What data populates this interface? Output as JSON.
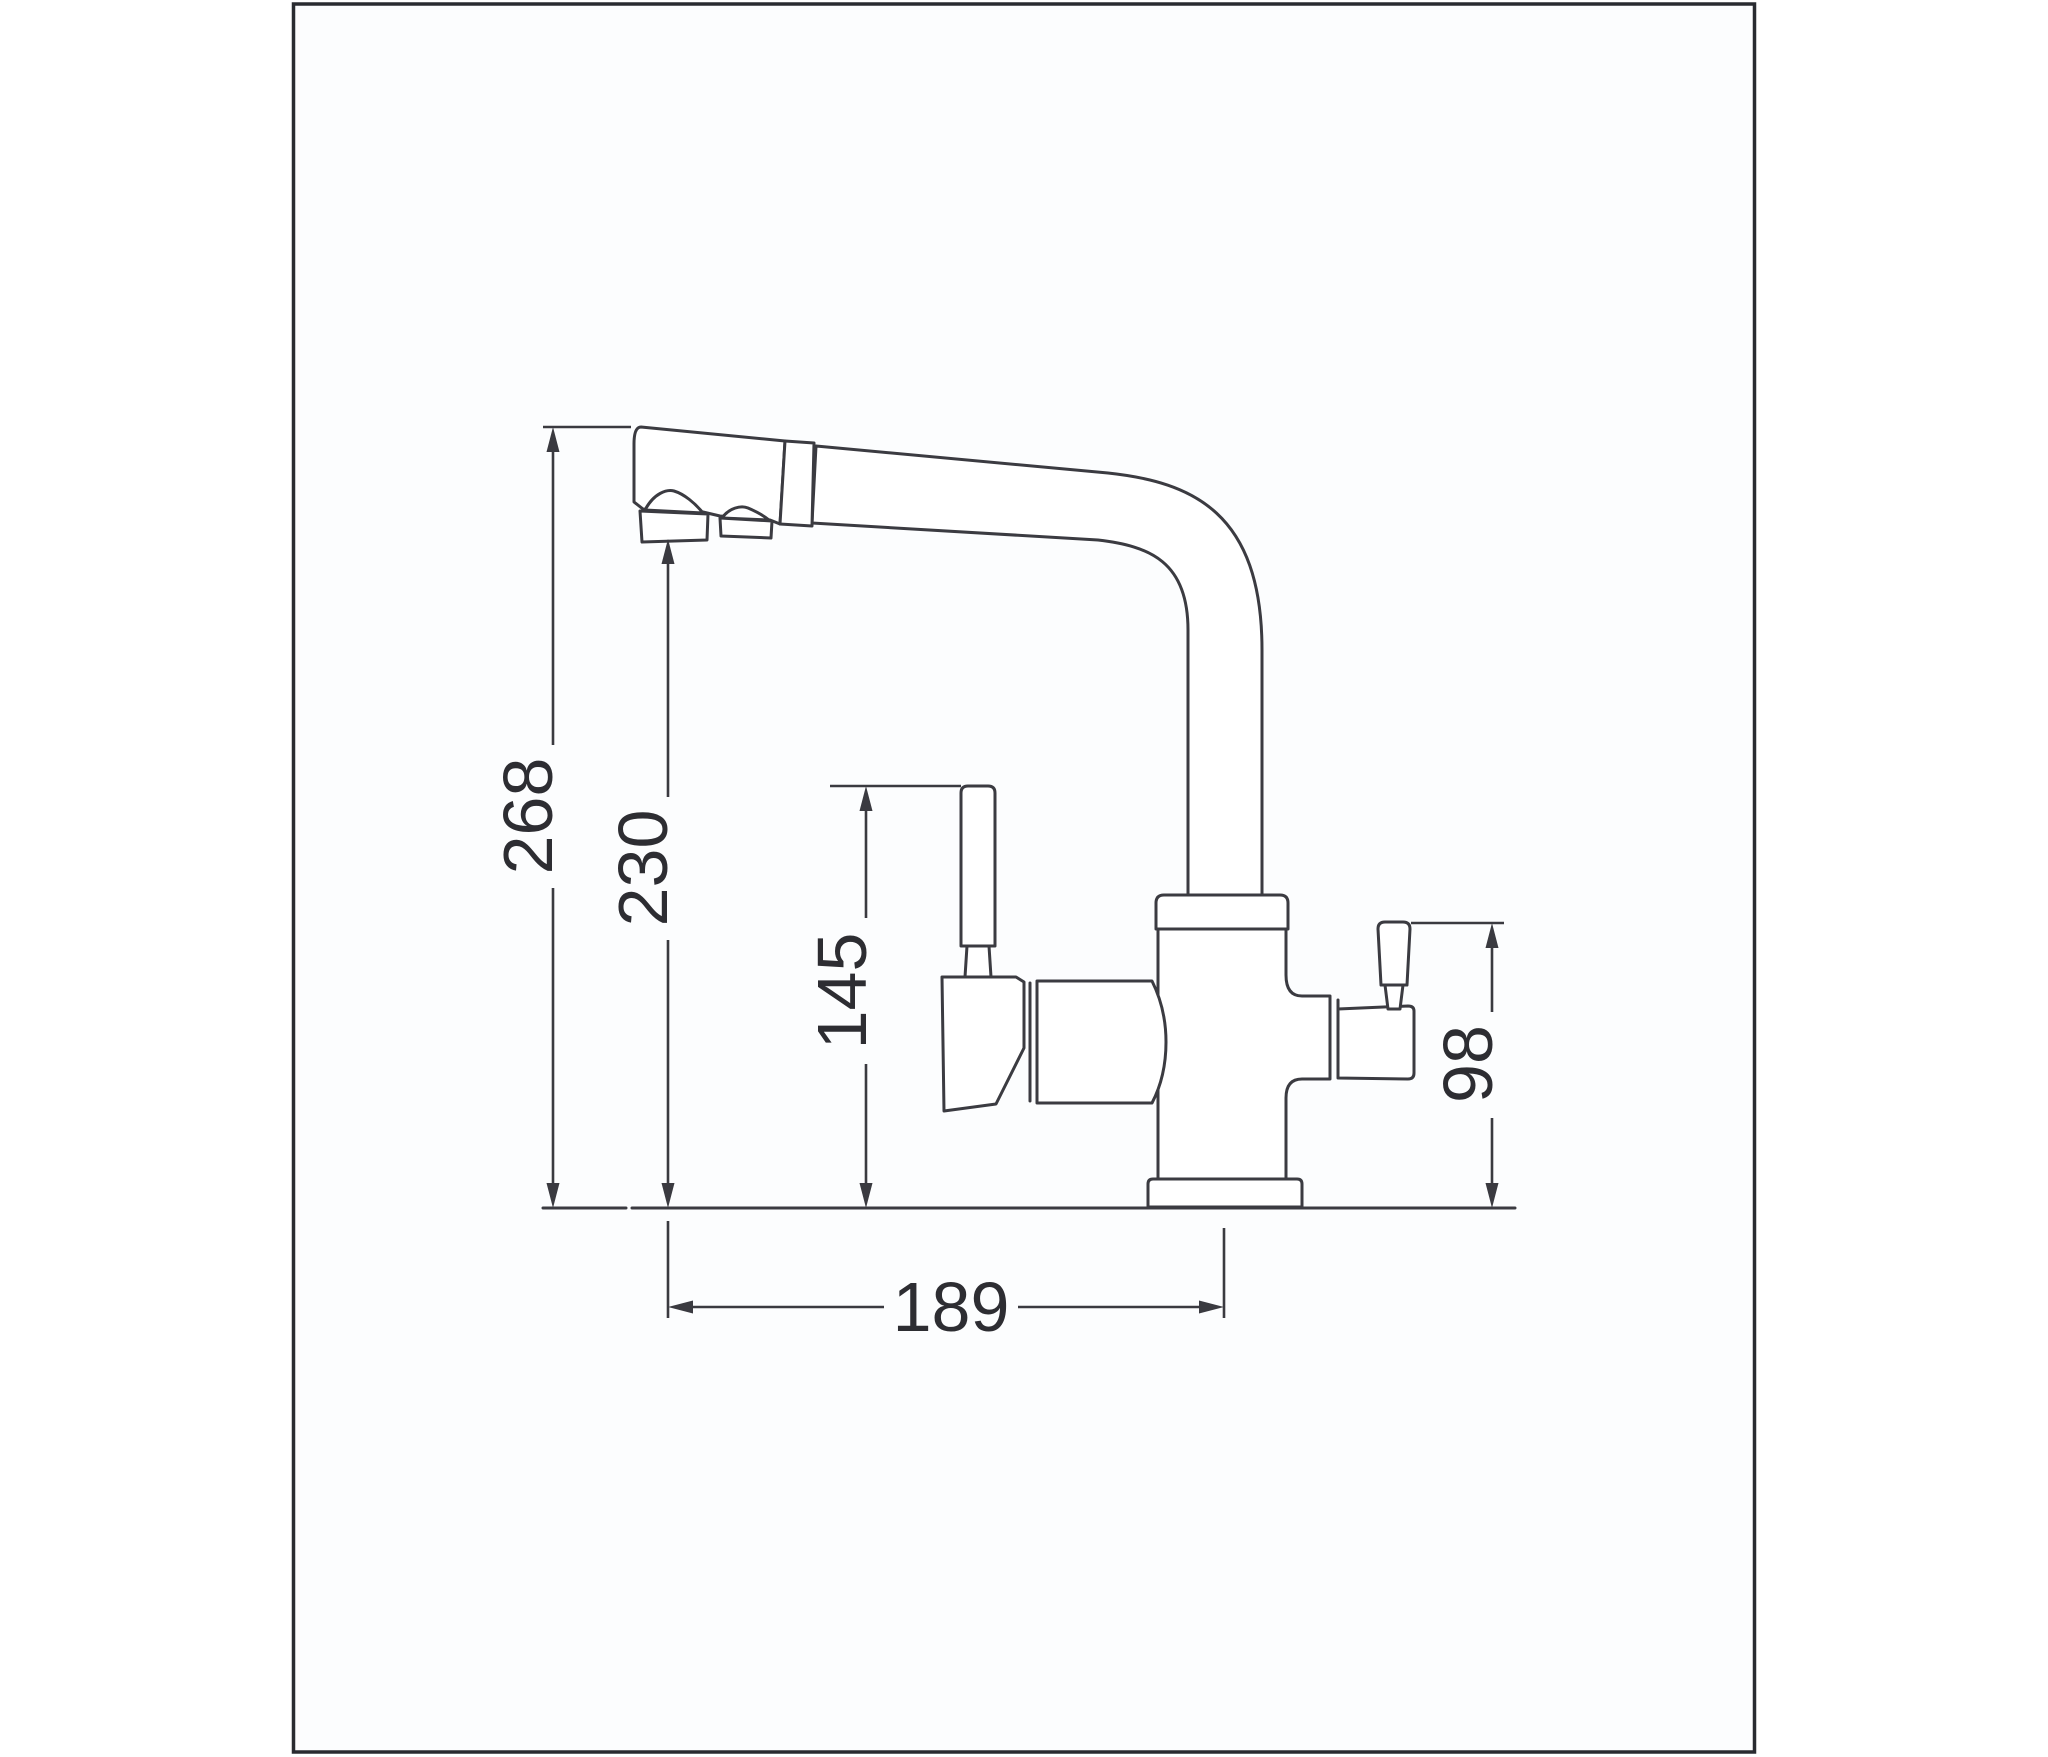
{
  "drawing": {
    "type": "faucet-dimension-diagram",
    "dimensions": {
      "total_height": "268",
      "spout_outlet_height": "230",
      "lever_height": "145",
      "side_outlet_height": "98",
      "spout_reach": "189"
    },
    "colors": {
      "line": "#3b3b41",
      "dimension_line": "#3a3a40",
      "text": "#2d2d32",
      "frame": "#292b30",
      "paper": "#fcfdfe",
      "background": "#ffffff"
    }
  }
}
